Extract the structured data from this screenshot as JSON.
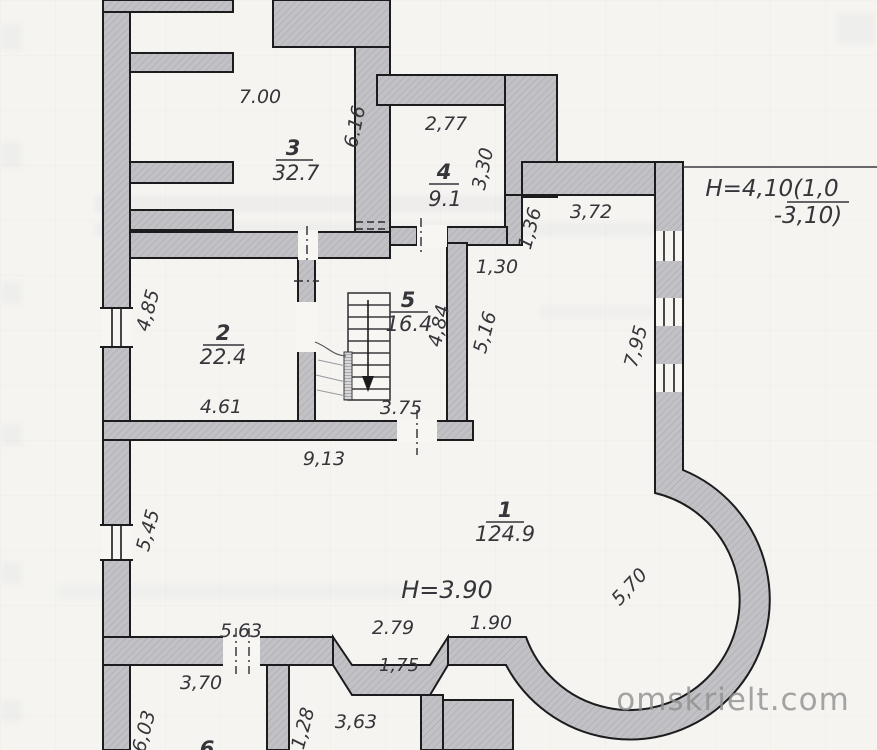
{
  "document": {
    "type": "scanned floor plan drawing",
    "paper_color": "#f5f4f1",
    "wall_color": "#c2c2c6",
    "line_color": "#1c1c1e"
  },
  "watermark": {
    "text": "omskrielt.com",
    "color": "#8f8f8f"
  },
  "plan": {
    "rooms": [
      {
        "number": "1",
        "area": "124.9"
      },
      {
        "number": "2",
        "area": "22.4"
      },
      {
        "number": "3",
        "area": "32.7"
      },
      {
        "number": "4",
        "area": "9.1"
      },
      {
        "number": "5",
        "area": "16.4"
      },
      {
        "number": "6",
        "area": ""
      }
    ],
    "ceiling_heights": {
      "room1": "H=3.90",
      "upper_right_line1": "H=4,10(1,0",
      "upper_right_line2": "-3,10)"
    },
    "dimensions": {
      "room3_width": "7.00",
      "room3_depth": "6.16",
      "room4_width": "2,77",
      "room4_depth": "3,30",
      "seg_1_36": "1,36",
      "top_wall_right": "3,72",
      "seg_1_30": "1,30",
      "right_wall": "7,95",
      "hall_wall": "5,16",
      "room5_depth": "4,84",
      "room2_depth": "4,85",
      "room2_width": "4.61",
      "room5_width": "3.75",
      "hall_width": "9,13",
      "left_wall_lower": "5,45",
      "bay_wall": "5,70",
      "bottom_wall_left": "5.63",
      "bottom_wall_mid": "2.79",
      "bottom_wall_right": "1.90",
      "bottom_step": "1,75",
      "room6_width": "3,70",
      "room6_depth": "6,03",
      "seg_1_28": "1,28",
      "room7_width": "3,63"
    }
  }
}
